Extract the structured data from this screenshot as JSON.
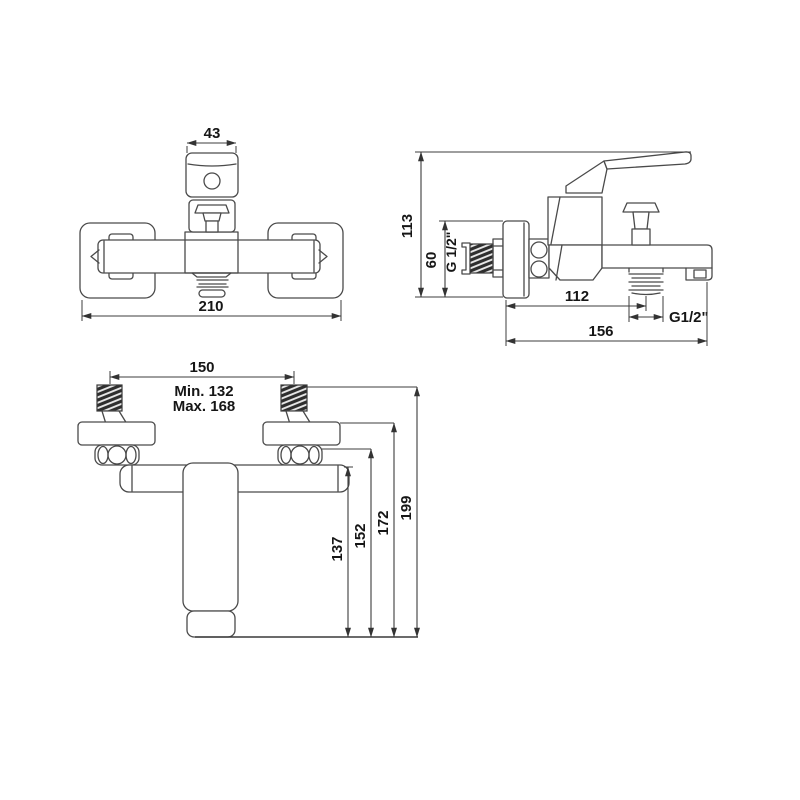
{
  "drawing": {
    "kind": "bath-shower-mixer-technical-drawing",
    "background": "#ffffff",
    "line_color": "#4a4a4a",
    "text_color": "#161616"
  },
  "views": {
    "front": {
      "label": "front-view",
      "dim_handle_width": "43",
      "dim_overall_width": "210"
    },
    "side": {
      "label": "side-view",
      "dim_overall_height": "113",
      "dim_wall_plate_height": "60",
      "dim_shower_outlet_thread": "G 1/2\"",
      "dim_wall_to_spout_outlet": "112",
      "dim_spout_outlet_thread": "G1/2\"",
      "dim_overall_depth": "156"
    },
    "top": {
      "label": "top-view",
      "dim_inlet_spacing": "150",
      "dim_inlet_spacing_min": "Min. 132",
      "dim_inlet_spacing_max": "Max. 168",
      "dim_body_projection": "137",
      "dim_nut_projection": "152",
      "dim_escutcheon_projection": "172",
      "dim_overall_projection": "199"
    }
  }
}
